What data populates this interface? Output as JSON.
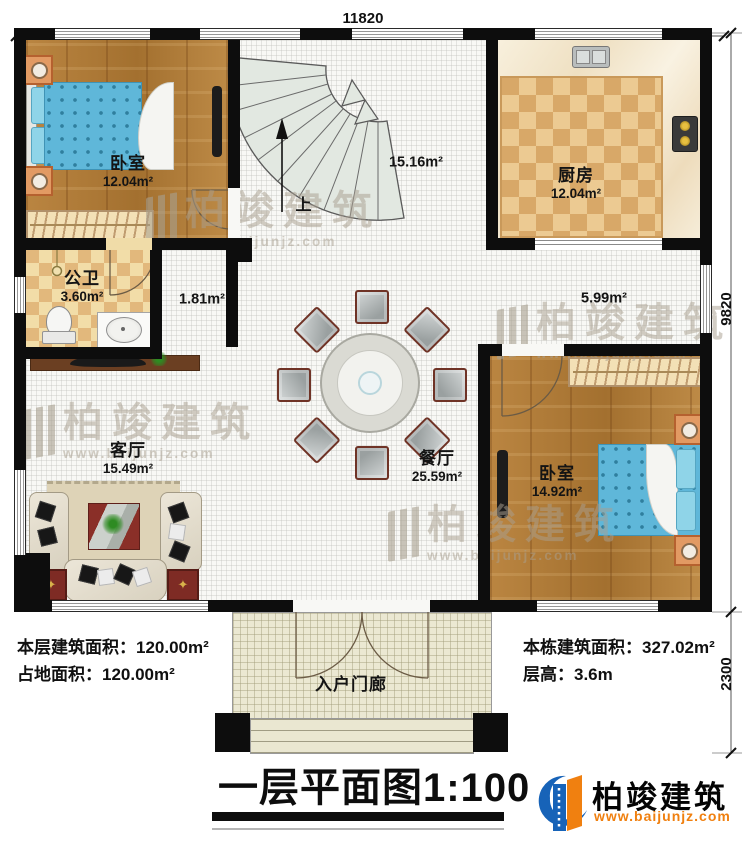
{
  "dimensions": {
    "top_width": "11820",
    "main_height": "9820",
    "porch_height": "2300"
  },
  "rooms": {
    "bedroom1": {
      "name": "卧室",
      "area": "12.04m²"
    },
    "stair_hall": {
      "area": "15.16m²"
    },
    "kitchen": {
      "name": "厨房",
      "area": "12.04m²"
    },
    "bathroom": {
      "name": "公卫",
      "area": "3.60m²"
    },
    "corridor": {
      "area": "1.81m²"
    },
    "passage": {
      "area": "5.99m²"
    },
    "living_room": {
      "name": "客厅",
      "area": "15.49m²"
    },
    "dining_room": {
      "name": "餐厅",
      "area": "25.59m²"
    },
    "bedroom2": {
      "name": "卧室",
      "area": "14.92m²"
    },
    "porch": {
      "name": "入户门廊"
    }
  },
  "stairs": {
    "up_label": "上"
  },
  "stats": {
    "floor_area": {
      "label": "本层建筑面积：",
      "value": "120.00m²"
    },
    "land_area": {
      "label": "占地面积：",
      "value": "120.00m²"
    },
    "building_area": {
      "label": "本栋建筑面积：",
      "value": "327.02m²"
    },
    "story_height": {
      "label": "层高：",
      "value": "3.6m"
    }
  },
  "title": {
    "name": "一层平面图",
    "scale": "1:100"
  },
  "brand": {
    "name": "柏竣建筑",
    "url": "www.baijunjz.com"
  },
  "watermark": {
    "name": "柏竣建筑",
    "url": "www.baijunjz.com"
  },
  "colors": {
    "wall": "#0d0d0d",
    "brand_blue": "#1763b8",
    "brand_orange": "#f08010"
  }
}
